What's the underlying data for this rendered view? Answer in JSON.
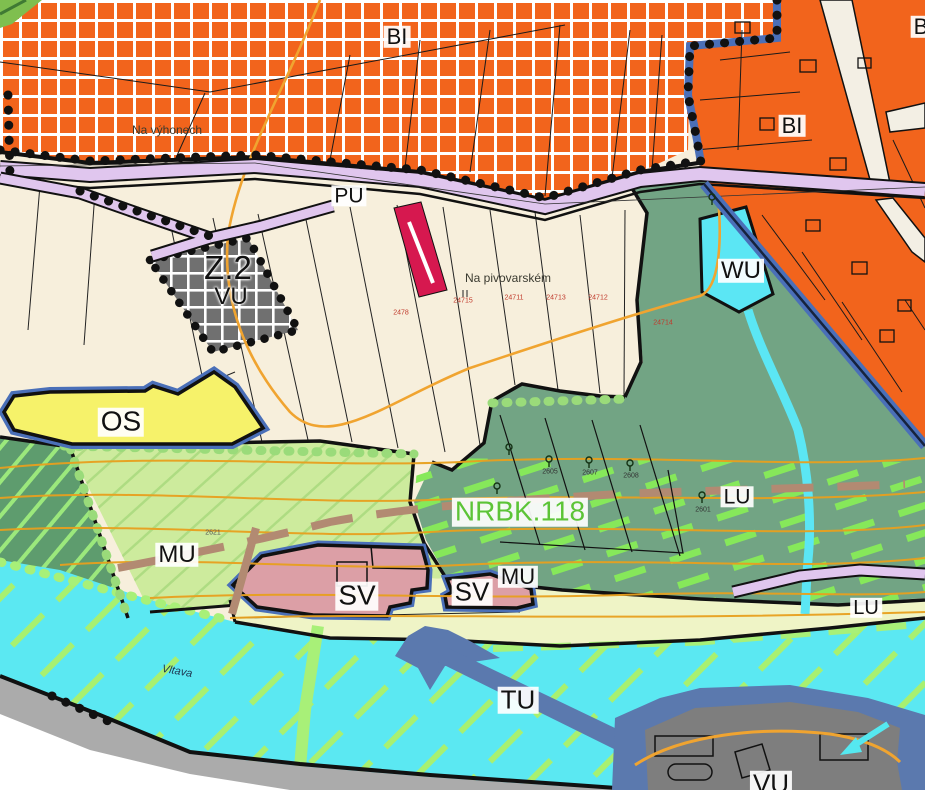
{
  "map": {
    "title": "Zoning plan map extract (územní plán)",
    "zone_labels": {
      "bi_top": "BI",
      "bi_right": "BI",
      "bi_corner": "B",
      "pu": "PU",
      "z2": "Z.2",
      "vu_top": "VU",
      "wu": "WU",
      "os": "OS",
      "nrbk": "NRBK.118",
      "lu_mid": "LU",
      "lu_right": "LU",
      "mu_left": "MU",
      "mu_small": "MU",
      "sv_large": "SV",
      "sv_small": "SV",
      "tu": "TU",
      "vu_bottom": "VU"
    },
    "place_labels": {
      "na_vyhonech": "Na výhonech",
      "na_pivovarskem": "Na pivovarském",
      "vltava": "Vltava"
    },
    "parcel_numbers": [
      "2478",
      "24715",
      "24711",
      "24713",
      "24712",
      "24714",
      "2621"
    ],
    "tree_numbers": [
      "2605",
      "2607",
      "2608",
      "2601"
    ],
    "colors": {
      "bi_orange": "#F2641C",
      "cream": "#F7EFDC",
      "road_lavender": "#E0C6EE",
      "vu_gray": "#707070",
      "crimson": "#D6184F",
      "sage_green": "#72A484",
      "mu_green": "#CDEB9D",
      "dark_green": "#5E9C6E",
      "os_yellow": "#F6F26A",
      "sv_pink": "#DC9FA6",
      "pale_yellow": "#EFF4C6",
      "river_cyan": "#5BE8F2",
      "wu_cyan": "#5BE6F4",
      "tu_slate": "#5B79AE",
      "island_gray": "#7E7E7E",
      "halo_blue": "#4A6FB8",
      "contour_orange": "#E8A01E",
      "path_brown": "#B28A72",
      "nrbk_lime": "#86E85A",
      "nrbk_text": "#5CC437"
    }
  }
}
